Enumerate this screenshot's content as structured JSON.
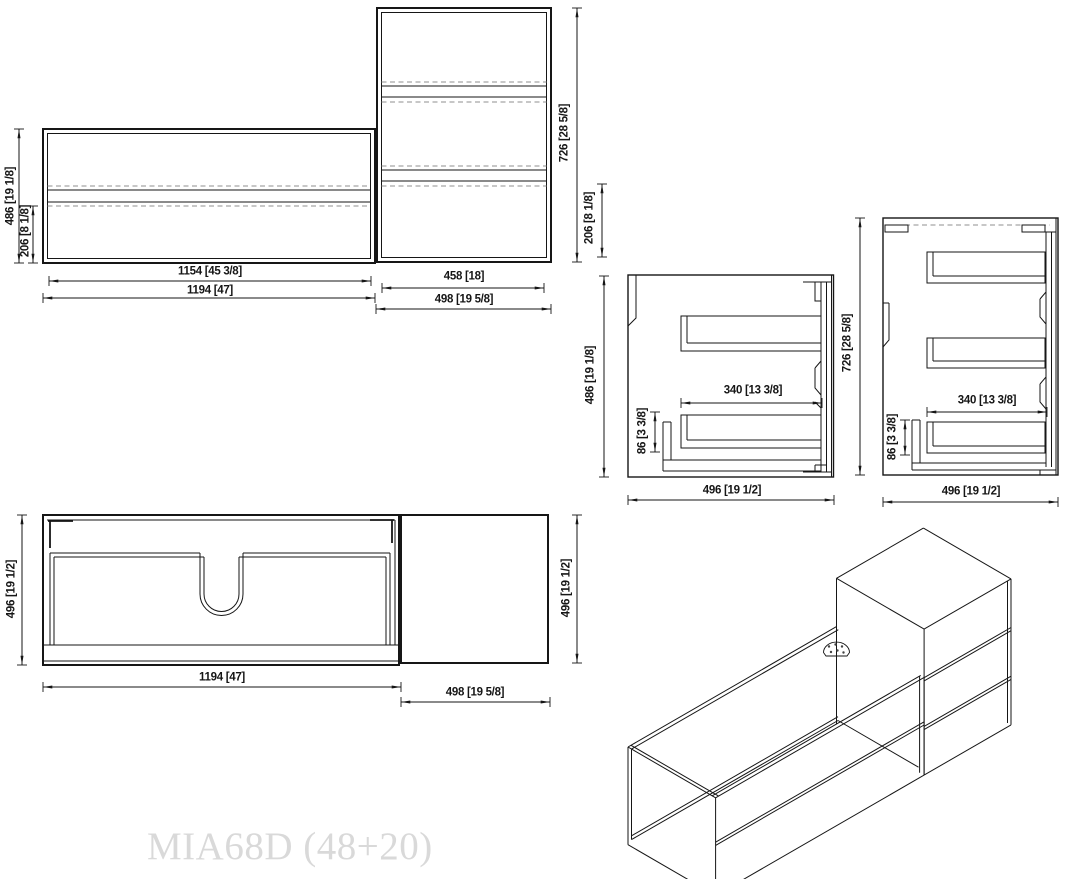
{
  "title": "MIA68D (48+20)",
  "dimensions": {
    "front_wide": {
      "height": "486 [19 1/8]",
      "drawer": "206 [8 1/8]",
      "inner_width": "1154 [45 3/8]",
      "width": "1194 [47]"
    },
    "front_tall": {
      "height": "726 [28 5/8]",
      "drawer": "206 [8 1/8]",
      "inner_width": "458 [18]",
      "width": "498 [19 5/8]"
    },
    "side_wide": {
      "height": "486 [19 1/8]",
      "slide": "340 [13 3/8]",
      "offset": "86 [3 3/8]",
      "depth": "496 [19 1/2]"
    },
    "side_tall": {
      "height": "726 [28 5/8]",
      "slide": "340 [13 3/8]",
      "offset": "86 [3 3/8]",
      "depth": "496 [19 1/2]"
    },
    "top_wide": {
      "depth": "496 [19 1/2]",
      "width": "1194 [47]"
    },
    "top_tall": {
      "depth": "496 [19 1/2]",
      "width": "498 [19 5/8]"
    }
  },
  "colors": {
    "line": "#161616",
    "dashed": "#8f8f8f",
    "watermark": "#d9d9d9",
    "background": "#ffffff"
  }
}
